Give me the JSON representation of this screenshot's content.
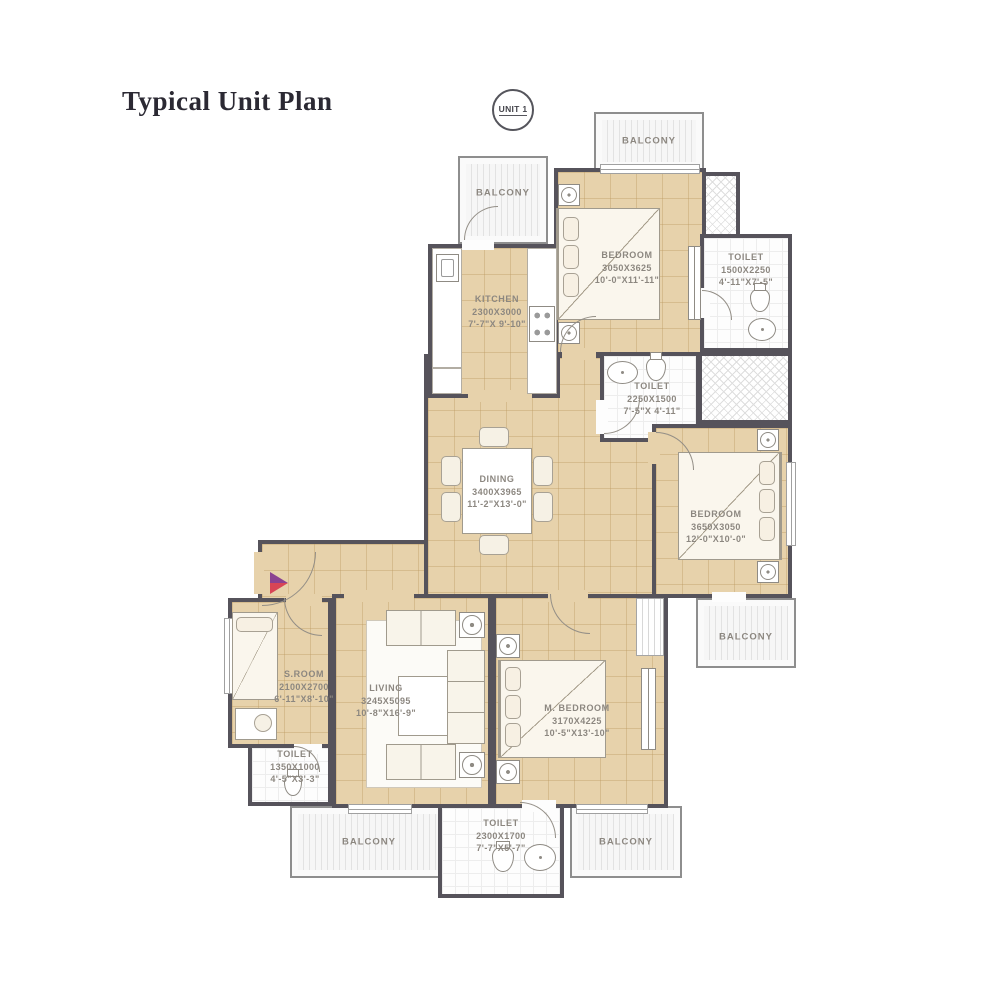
{
  "title": "Typical Unit Plan",
  "unit_badge": "UNIT 1",
  "balcony_label": "BALCONY",
  "rooms": {
    "bedroom_top": {
      "name": "BEDROOM",
      "dim_mm": "3050X3625",
      "dim_ft": "10'-0\"X11'-11\""
    },
    "toilet_top_right": {
      "name": "TOILET",
      "dim_mm": "1500X2250",
      "dim_ft": "4'-11\"X7'-5\""
    },
    "kitchen": {
      "name": "KITCHEN",
      "dim_mm": "2300X3000",
      "dim_ft": "7'-7\"X 9'-10\""
    },
    "toilet_mid": {
      "name": "TOILET",
      "dim_mm": "2250X1500",
      "dim_ft": "7'-5\"X 4'-11\""
    },
    "dining": {
      "name": "DINING",
      "dim_mm": "3400X3965",
      "dim_ft": "11'-2\"X13'-0\""
    },
    "bedroom_right": {
      "name": "BEDROOM",
      "dim_mm": "3650X3050",
      "dim_ft": "12'-0\"X10'-0\""
    },
    "s_room": {
      "name": "S.ROOM",
      "dim_mm": "2100X2700",
      "dim_ft": "6'-11\"X8'-10\""
    },
    "living": {
      "name": "LIVING",
      "dim_mm": "3245X5095",
      "dim_ft": "10'-8\"X16'-9\""
    },
    "m_bedroom": {
      "name": "M. BEDROOM",
      "dim_mm": "3170X4225",
      "dim_ft": "10'-5\"X13'-10\""
    },
    "toilet_bottom_left": {
      "name": "TOILET",
      "dim_mm": "1350X1000",
      "dim_ft": "4'-5\"X3'-3\""
    },
    "toilet_bottom": {
      "name": "TOILET",
      "dim_mm": "2300X1700",
      "dim_ft": "7'-7\"X5'-7\""
    }
  },
  "colors": {
    "wall": "#56535B",
    "floor": "#E7D2AB",
    "label_text": "#8C8780",
    "title_text": "#2B2933",
    "entry_marker_top": "#8A4191",
    "entry_marker_bottom": "#D84556"
  }
}
